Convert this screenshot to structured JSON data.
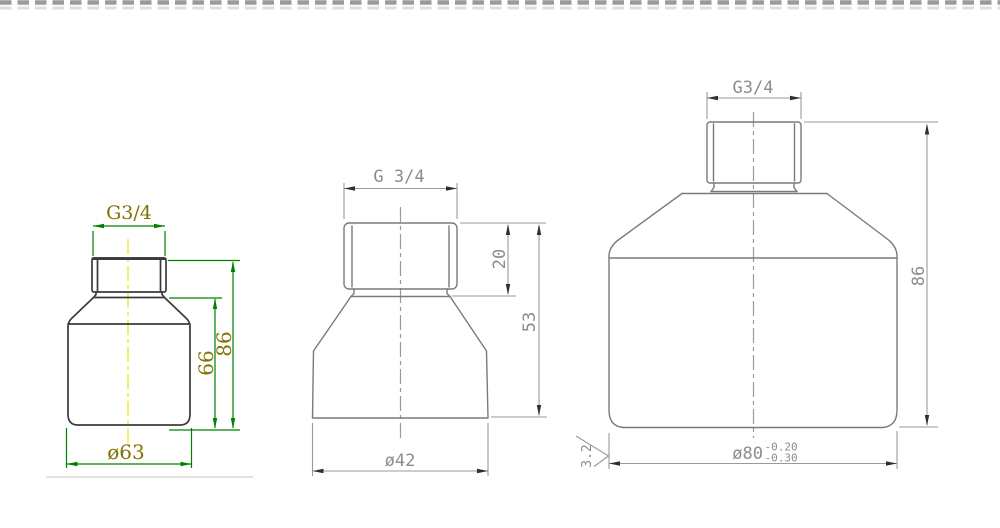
{
  "title": "threaded-reducer-fitting-technical-drawing",
  "colors": {
    "background": "#ffffff",
    "left_outline": "#3b3b3b",
    "left_dimension": "#008000",
    "left_text": "#827200",
    "centerline_yellow": "#f0e832",
    "gray_outline": "#7a7a7a",
    "gray_dimension": "#9a9a9a",
    "gray_text": "#8c8c8c",
    "gray_arrow": "#2f2f2f",
    "border_dash": "#9b9b9b",
    "border_dash_light": "#dedede",
    "divider_line": "#d8d8d8"
  },
  "views": {
    "left": {
      "thread_label": "G3/4",
      "dim_body_height": "66",
      "dim_total_height": "86",
      "dim_diameter": "ø63"
    },
    "middle": {
      "thread_label": "G 3/4",
      "dim_thread_height": "20",
      "dim_total_height": "53",
      "dim_diameter": "ø42"
    },
    "right": {
      "thread_label": "G3/4",
      "dim_total_height": "86",
      "dim_diameter": "ø80",
      "tolerance_upper": "-0.20",
      "tolerance_lower": "-0.30",
      "surface_roughness": "3.2"
    }
  }
}
